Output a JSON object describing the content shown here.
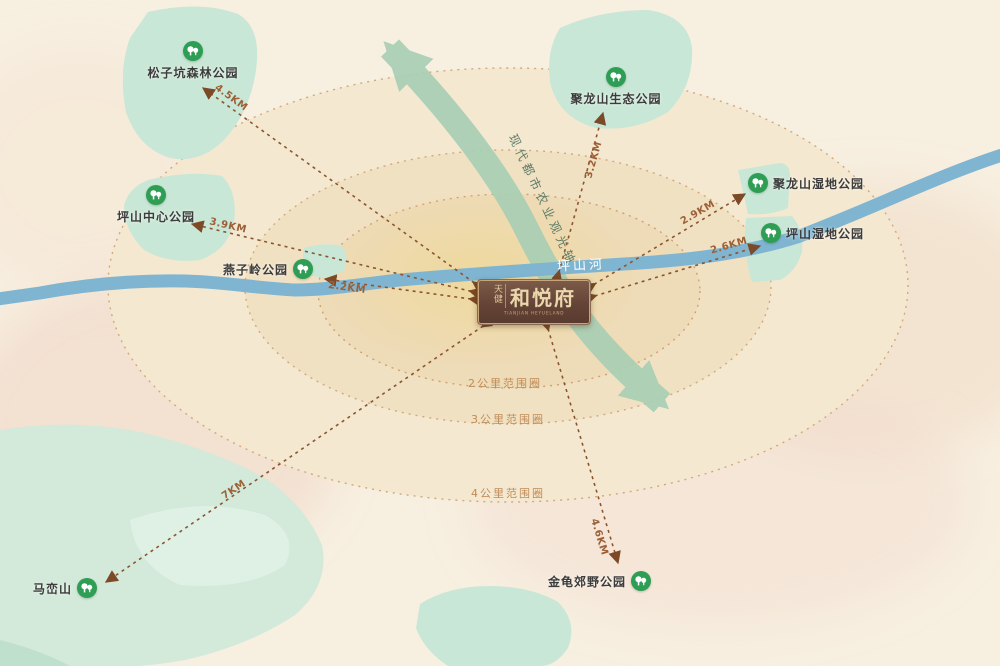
{
  "project": {
    "brand": "天健",
    "name": "和悦府",
    "subtitle": "TIANJIAN HEYUELAND"
  },
  "river": {
    "label": "坪山河"
  },
  "corridor": {
    "label": "现代都市农业观光轴"
  },
  "rings": [
    {
      "label": "2公里范围圈"
    },
    {
      "label": "3公里范围圈"
    },
    {
      "label": "4公里范围圈"
    }
  ],
  "parks": [
    {
      "name": "松子坑森林公园",
      "distance": "4.5KM"
    },
    {
      "name": "坪山中心公园",
      "distance": "3.9KM"
    },
    {
      "name": "燕子岭公园",
      "distance": "2.2KM"
    },
    {
      "name": "聚龙山生态公园",
      "distance": "3.2KM"
    },
    {
      "name": "聚龙山湿地公园",
      "distance": "2.9KM"
    },
    {
      "name": "坪山湿地公园",
      "distance": "2.6KM"
    },
    {
      "name": "马峦山",
      "distance": "7KM"
    },
    {
      "name": "金龟郊野公园",
      "distance": "4.6KM"
    }
  ],
  "colors": {
    "background": "#f7efe0",
    "ring_fill_outer": "#f4e8d0",
    "ring_fill_mid": "#f1e1c3",
    "ring_fill_inner": "#eedbb7",
    "ring_stroke": "#d2a87c",
    "park_green": "#c9e7d6",
    "marker_green": "#2e9e54",
    "river_blue": "#7fb5d1",
    "corridor_green": "#a9cfb4",
    "arrow_brown": "#8a5530",
    "arrowhead_brown": "#7c4a26",
    "logo_brown": "#654437",
    "logo_gold": "#ead7ac",
    "distance_text": "#9c6038",
    "ring_label_text": "#c08b58"
  }
}
